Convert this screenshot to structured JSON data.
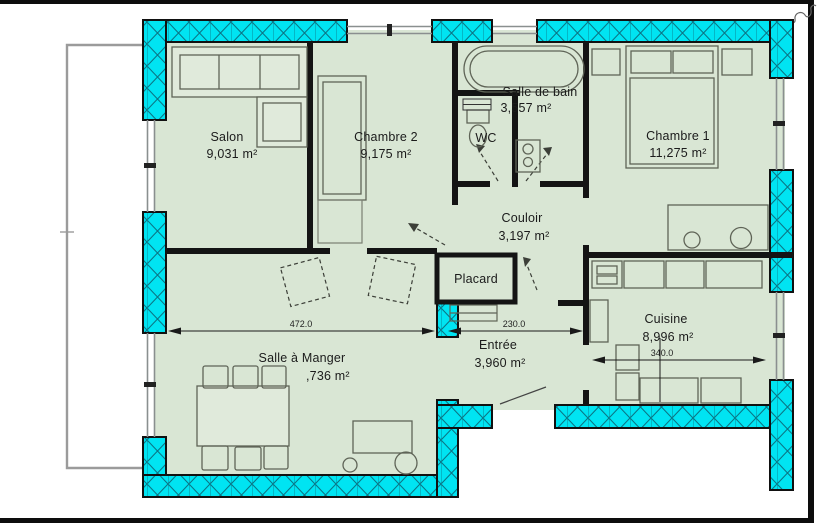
{
  "rooms": {
    "salon": {
      "name": "Salon",
      "area": "9,031 m²"
    },
    "chambre2": {
      "name": "Chambre 2",
      "area": "9,175 m²"
    },
    "salle_de_bain": {
      "name": "Salle de bain",
      "area": "3,557 m²"
    },
    "wc": {
      "name": "WC",
      "area": ""
    },
    "chambre1": {
      "name": "Chambre 1",
      "area": "11,275 m²"
    },
    "couloir": {
      "name": "Couloir",
      "area": "3,197 m²"
    },
    "placard": {
      "name": "Placard",
      "area": ""
    },
    "salle_a_manger": {
      "name": "Salle à Manger",
      "area": ",736 m²"
    },
    "entree": {
      "name": "Entrée",
      "area": "3,960 m²"
    },
    "cuisine": {
      "name": "Cuisine",
      "area": "8,996 m²"
    }
  },
  "dimensions": {
    "dining_width": "472.0",
    "entry_width": "230.0",
    "kitchen_width": "340.0"
  },
  "colors": {
    "exterior_wall": "#00e4f2",
    "wall_hatch": "#0a7585",
    "floor": "#d9e6d4",
    "interior_wall": "#141414",
    "furniture_line": "#5f6457",
    "balcony_line": "#9b9b9b",
    "frame": "#0d0d0d"
  }
}
